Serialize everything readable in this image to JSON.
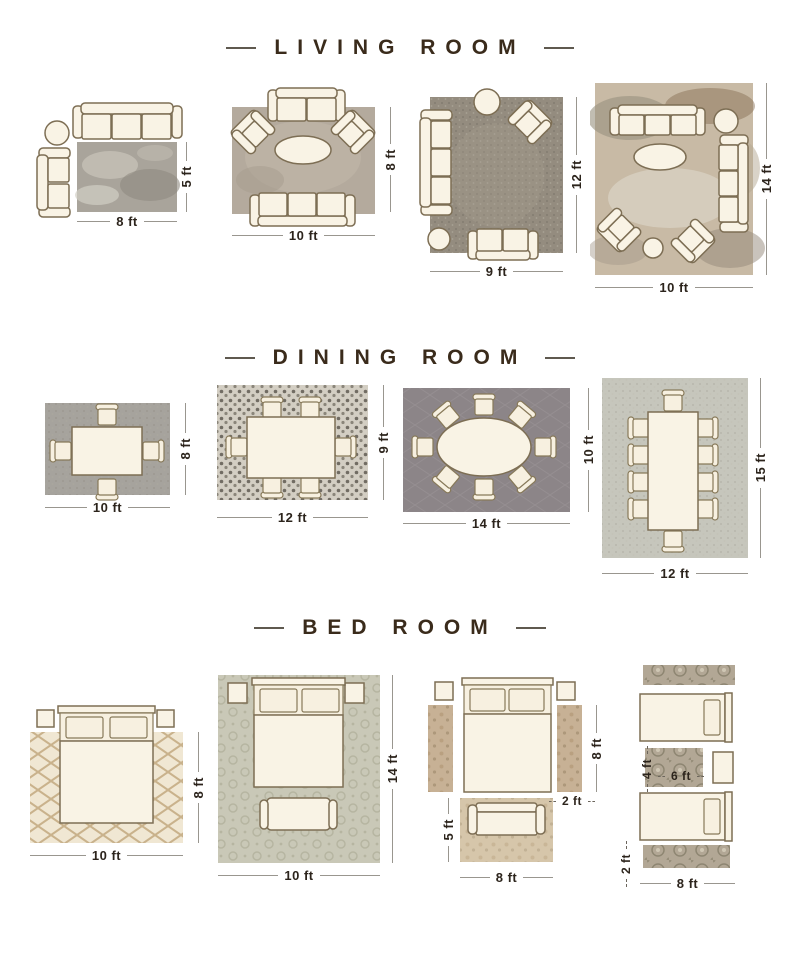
{
  "title_dash": "—",
  "sections": [
    {
      "id": "living-room",
      "title": "LIVING ROOM",
      "layouts": [
        {
          "name": "living-rug-8x5",
          "width_label": "8 ft",
          "height_label": "5 ft"
        },
        {
          "name": "living-rug-10x8",
          "width_label": "10 ft",
          "height_label": "8 ft"
        },
        {
          "name": "living-rug-9x12",
          "width_label": "9 ft",
          "height_label": "12 ft"
        },
        {
          "name": "living-rug-10x14",
          "width_label": "10 ft",
          "height_label": "14 ft"
        }
      ]
    },
    {
      "id": "dining-room",
      "title": "DINING ROOM",
      "layouts": [
        {
          "name": "dining-rug-10x8",
          "width_label": "10 ft",
          "height_label": "8 ft"
        },
        {
          "name": "dining-rug-12x9",
          "width_label": "12 ft",
          "height_label": "9 ft"
        },
        {
          "name": "dining-rug-14x10",
          "width_label": "14 ft",
          "height_label": "10 ft"
        },
        {
          "name": "dining-rug-12x15",
          "width_label": "12 ft",
          "height_label": "15 ft"
        }
      ]
    },
    {
      "id": "bed-room",
      "title": "BED ROOM",
      "layouts": [
        {
          "name": "bed-rug-10x8",
          "width_label": "10 ft",
          "height_label": "8 ft"
        },
        {
          "name": "bed-rug-10x14",
          "width_label": "10 ft",
          "height_label": "14 ft"
        },
        {
          "name": "bed-runners-and-foot-rug",
          "runner_length_label": "8 ft",
          "runner_width_label": "2 ft",
          "foot_rug_height_label": "5 ft",
          "foot_rug_width_label": "8 ft"
        },
        {
          "name": "twin-beds-runners",
          "small_rug_height_label": "4 ft",
          "small_rug_width_label": "6 ft",
          "runner_height_label": "2 ft",
          "bed_width_label": "8 ft"
        }
      ]
    }
  ],
  "colors": {
    "title_text": "#3a2b1b",
    "dim_text": "#2c241c",
    "furniture_fill": "#f9f3e5",
    "furniture_stroke": "#7d6e54"
  }
}
